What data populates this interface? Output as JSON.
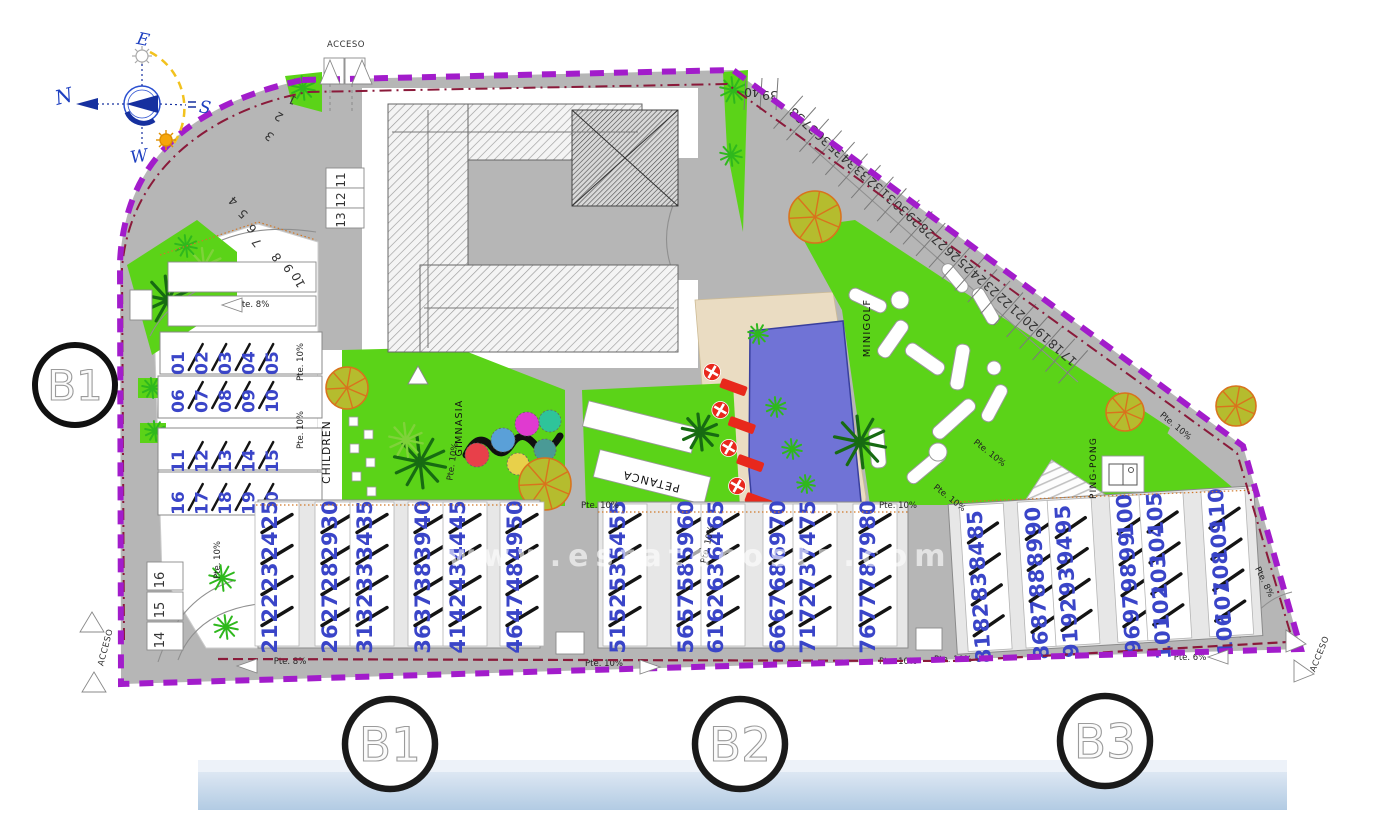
{
  "access_label": "ACCESO",
  "watermark": "www.estatecosta.com",
  "compass": {
    "north": "N",
    "south": "S",
    "east": "E",
    "west": "W"
  },
  "block_markers": {
    "left_road": "B1",
    "bottom": [
      "B1",
      "B2",
      "B3"
    ]
  },
  "amenity_labels": {
    "children": "CHILDREN",
    "gimnasia": "GIMNASIA",
    "minigolf": "MINIGOLF",
    "petanca": "PETANCA",
    "ping_pong": "PING-PONG"
  },
  "slope_labels": [
    "Pte. 8%",
    "Pte. 10%",
    "Pte. 10%",
    "Pte. 10%",
    "Pte. 8%",
    "Pte. 10%",
    "Pte. 10%",
    "Pte. 10%",
    "Pte. 10%",
    "Pte. 10%",
    "Pte. 6%",
    "Pte. 10%",
    "Pte. 10%",
    "Pte. 10%",
    "Pte. 10%",
    "Pte. 8%",
    "Pte. 10%"
  ],
  "buildings": {
    "left_block": {
      "rows": [
        [
          "01",
          "02",
          "03",
          "04",
          "05"
        ],
        [
          "06",
          "07",
          "08",
          "09",
          "10"
        ],
        [
          "11",
          "12",
          "13",
          "14",
          "15"
        ],
        [
          "16",
          "17",
          "18",
          "19",
          "20"
        ]
      ]
    },
    "row_b1": {
      "groups": [
        [
          "21",
          "22",
          "23",
          "24",
          "25"
        ],
        [
          "26",
          "27",
          "28",
          "29",
          "30"
        ],
        [
          "31",
          "32",
          "33",
          "34",
          "35"
        ],
        [
          "36",
          "37",
          "38",
          "39",
          "40"
        ],
        [
          "41",
          "42",
          "43",
          "44",
          "45"
        ],
        [
          "46",
          "47",
          "48",
          "49",
          "50"
        ]
      ]
    },
    "row_b2": {
      "groups": [
        [
          "51",
          "52",
          "53",
          "54",
          "55"
        ],
        [
          "56",
          "57",
          "58",
          "59",
          "60"
        ],
        [
          "61",
          "62",
          "63",
          "64",
          "65"
        ],
        [
          "66",
          "67",
          "68",
          "69",
          "70"
        ],
        [
          "71",
          "72",
          "73",
          "74",
          "75"
        ],
        [
          "76",
          "77",
          "78",
          "79",
          "80"
        ]
      ]
    },
    "row_b3": {
      "groups": [
        [
          "81",
          "82",
          "83",
          "84",
          "85"
        ],
        [
          "86",
          "87",
          "88",
          "89",
          "90"
        ],
        [
          "91",
          "92",
          "93",
          "94",
          "95"
        ],
        [
          "96",
          "97",
          "98",
          "99",
          "100"
        ],
        [
          "101",
          "102",
          "103",
          "104",
          "105"
        ],
        [
          "106",
          "107",
          "108",
          "109",
          "110"
        ]
      ]
    }
  },
  "parking": {
    "left_curve": [
      "1",
      "2",
      "3",
      "4",
      "5",
      "6",
      "7",
      "8",
      "9",
      "10"
    ],
    "garage_column": [
      "11",
      "12",
      "13"
    ],
    "bottom_left_column": [
      "16",
      "15",
      "14"
    ],
    "diagonal_row": [
      "38",
      "37",
      "36",
      "35",
      "34",
      "33",
      "32",
      "31",
      "30",
      "29",
      "28",
      "27",
      "26",
      "25",
      "24",
      "23",
      "22",
      "21",
      "20",
      "19",
      "18",
      "17"
    ],
    "top_row": [
      "39",
      "40"
    ]
  },
  "colors": {
    "boundary": "#A21CCB",
    "inner_boundary": "#8A1A3A",
    "road": "#B6B6B6",
    "green": "#5BD318",
    "pool": "#7073D6",
    "deck": "#EADCC2",
    "unit_number": "#3A45C8",
    "lounger": "#E8281C",
    "tree_fill": "#B5BC2E",
    "tree_stroke": "#D9731D",
    "bottom_band": "#BFD3E8"
  }
}
